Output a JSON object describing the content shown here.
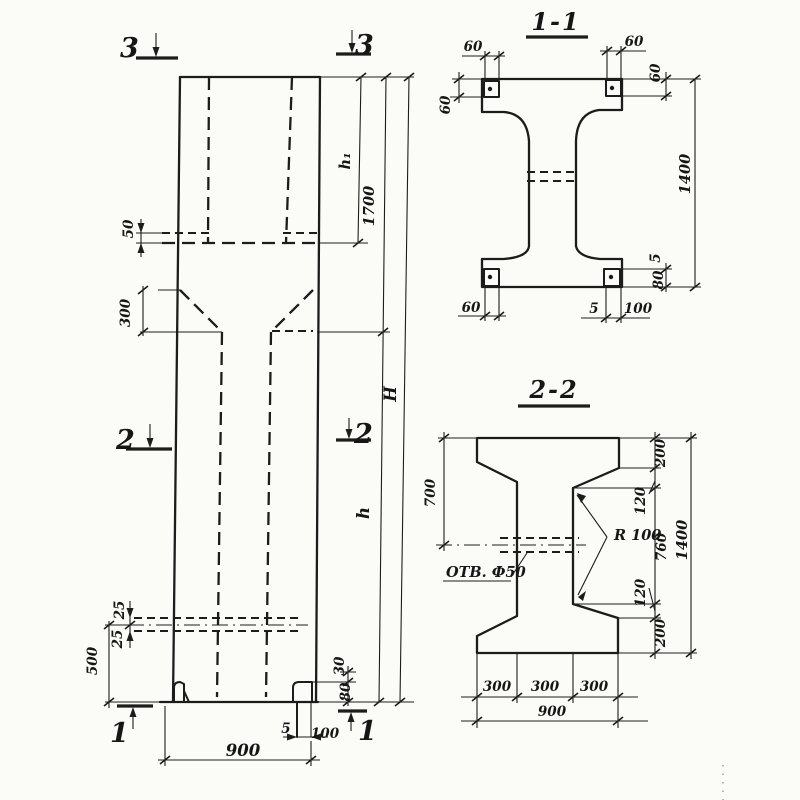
{
  "drawing_kind": "reinforced concrete column working drawing, elevation with two cross sections",
  "colors": {
    "ink": "#1c1c1c",
    "paper": "#fbfbf8"
  },
  "labels": {
    "elev": {
      "sec3_left": "3",
      "sec3_right": "3",
      "sec2_left": "2",
      "sec2_right": "2",
      "sec1_left": "1",
      "sec1_right": "1",
      "d50": "50",
      "d300": "300",
      "h1": "h₁",
      "d1700": "1700",
      "H": "H",
      "h": "h",
      "d25_top": "25",
      "d25_bottom": "25",
      "d500": "500",
      "d30": "30",
      "d80": "80",
      "d5": "5",
      "d100": "100",
      "d900": "900"
    },
    "s11": {
      "title": "1-1",
      "d60_tl": "60",
      "d60_tr": "60",
      "d60_right": "60",
      "d60_left": "60",
      "d1400": "1400",
      "d5_right": "5",
      "d80_right": "80",
      "d60_bl": "60",
      "d5_bottom": "5",
      "d100_bottom": "100"
    },
    "s22": {
      "title": "2-2",
      "d700": "700",
      "d200_top": "200",
      "d120_top": "120",
      "d760": "760",
      "d120_bottom": "120",
      "d200_bottom": "200",
      "d1400": "1400",
      "r100": "R 100",
      "hole": "ОТВ. Ф50",
      "d300_1": "300",
      "d300_2": "300",
      "d300_3": "300",
      "d900": "900"
    }
  }
}
